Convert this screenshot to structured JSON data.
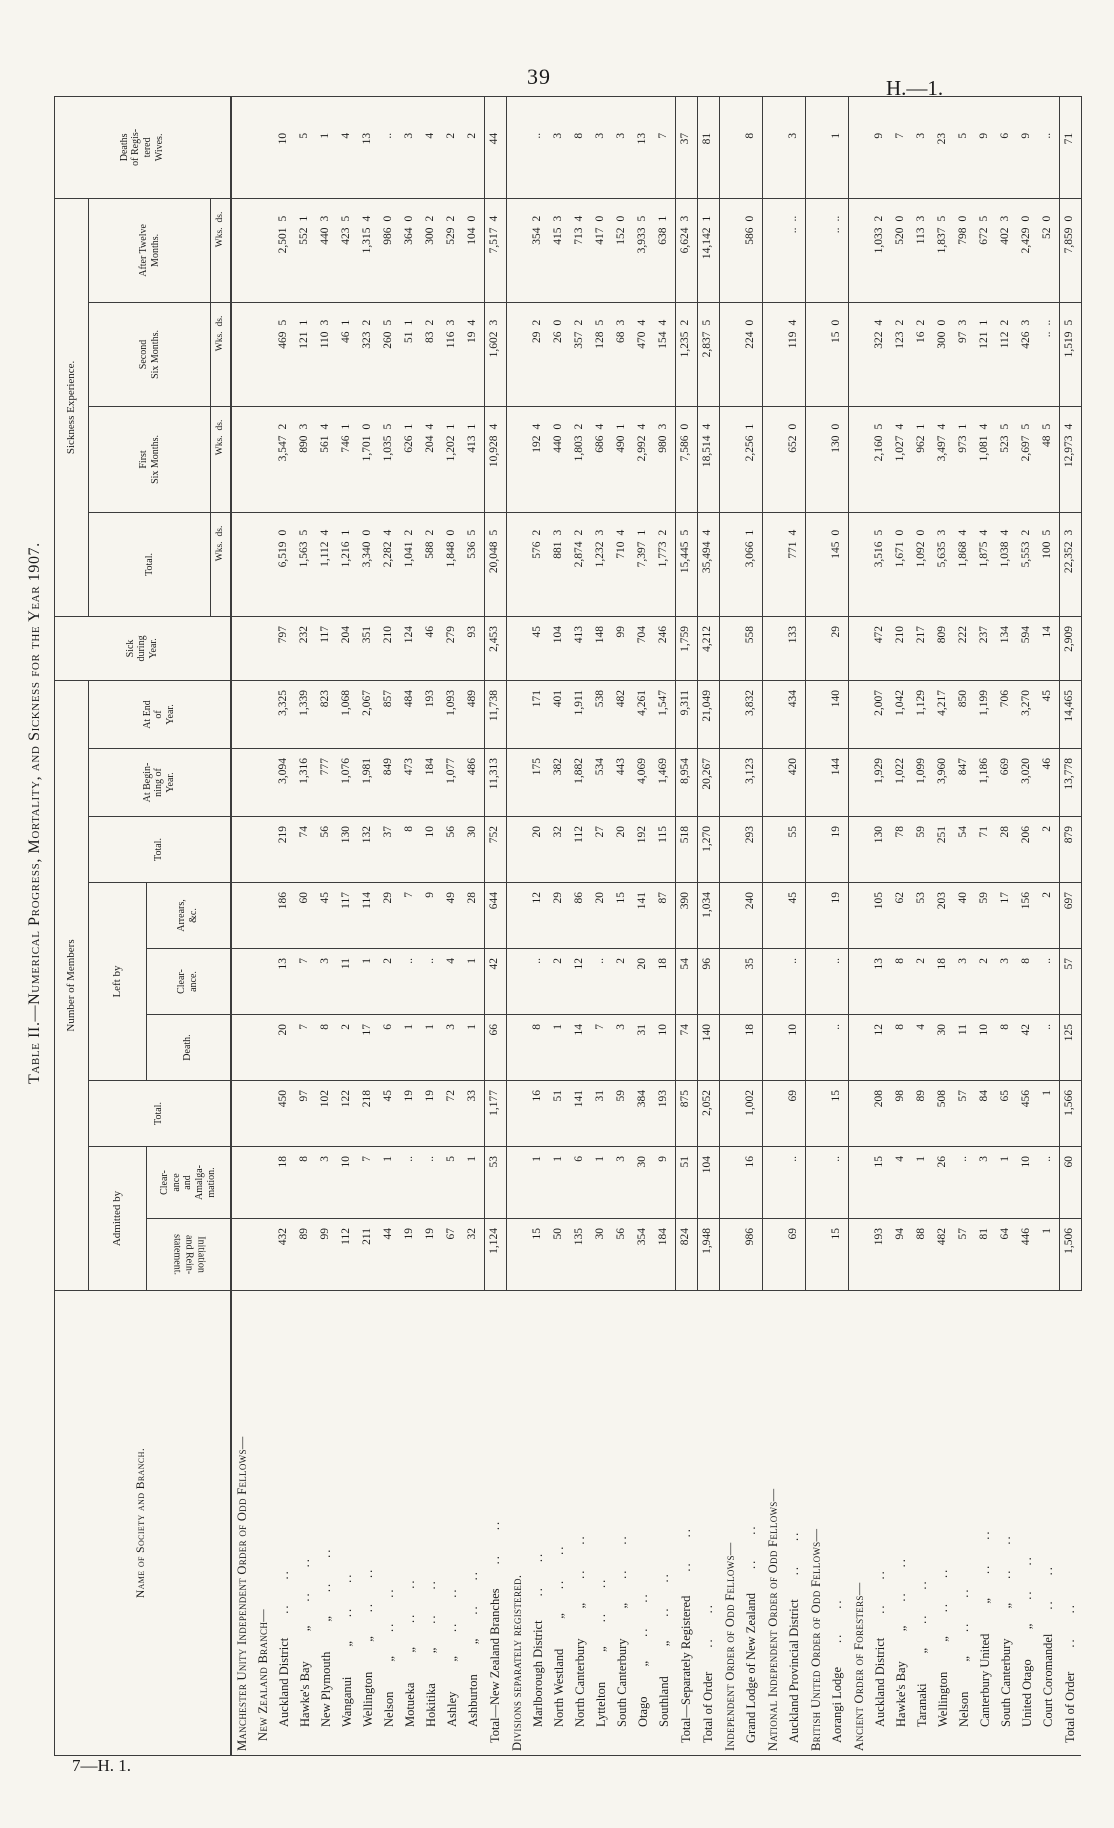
{
  "page": {
    "page_number": "39",
    "doc_ref": "H.—1.",
    "footer_ref": "7—H. 1.",
    "title": "Table II.—Numerical Progress, Mortality, and Sickness for the Year 1907."
  },
  "table": {
    "ditto_mark": "„",
    "leader_dots": "..",
    "header": {
      "name_col": "Name of Society and Branch.",
      "number_of_members": "Number of Members",
      "admitted_by": "Admitted by",
      "initiation": "Initiation\nand Rein-\nstatement.",
      "clearance_amalgamation": "Clear-\nance\nand\nAmalga-\nmation.",
      "total_admitted": "Total.",
      "left_by": "Left by",
      "death": "Death.",
      "clearance": "Clear-\nance.",
      "arrears": "Arrears,\n&c.",
      "total_left": "Total.",
      "at_beginning": "At Begin-\nning of\nYear.",
      "at_end": "At End\nof\nYear.",
      "sick_during_year": "Sick\nduring\nYear.",
      "sickness_experience": "Sickness Experience.",
      "total_sick": "Total.",
      "first_six": "First\nSix Months.",
      "second_six": "Second\nSix Months.",
      "after_twelve": "After Twelve\nMonths.",
      "deaths_wives": "Deaths\nof Regis-\ntered\nWives.",
      "wks": "Wks.",
      "ds": "ds."
    },
    "rows": [
      {
        "type": "heading",
        "level": 1,
        "text": "Manchester Unity Independent Order of Odd Fellows—"
      },
      {
        "type": "heading",
        "level": 2,
        "text": "New Zealand Branch—"
      },
      {
        "type": "data",
        "name": "Auckland District",
        "indent": 2,
        "v": [
          "432",
          "18",
          "450",
          "20",
          "13",
          "186",
          "219",
          "3,094",
          "3,325",
          "797",
          "6,519",
          "0",
          "3,547",
          "2",
          "469",
          "5",
          "2,501",
          "5",
          "10"
        ]
      },
      {
        "type": "data",
        "name": "Hawke's Bay",
        "ditto": true,
        "indent": 2,
        "v": [
          "89",
          "8",
          "97",
          "7",
          "7",
          "60",
          "74",
          "1,316",
          "1,339",
          "232",
          "1,563",
          "5",
          "890",
          "3",
          "121",
          "1",
          "552",
          "1",
          "5"
        ]
      },
      {
        "type": "data",
        "name": "New Plymouth",
        "ditto": true,
        "indent": 2,
        "v": [
          "99",
          "3",
          "102",
          "8",
          "3",
          "45",
          "56",
          "777",
          "823",
          "117",
          "1,112",
          "4",
          "561",
          "4",
          "110",
          "3",
          "440",
          "3",
          "1"
        ]
      },
      {
        "type": "data",
        "name": "Wanganui",
        "ditto": true,
        "indent": 2,
        "v": [
          "112",
          "10",
          "122",
          "2",
          "11",
          "117",
          "130",
          "1,076",
          "1,068",
          "204",
          "1,216",
          "1",
          "746",
          "1",
          "46",
          "1",
          "423",
          "5",
          "4"
        ]
      },
      {
        "type": "data",
        "name": "Wellington",
        "ditto": true,
        "indent": 2,
        "v": [
          "211",
          "7",
          "218",
          "17",
          "1",
          "114",
          "132",
          "1,981",
          "2,067",
          "351",
          "3,340",
          "0",
          "1,701",
          "0",
          "323",
          "2",
          "1,315",
          "4",
          "13"
        ]
      },
      {
        "type": "data",
        "name": "Nelson",
        "ditto": true,
        "indent": 2,
        "v": [
          "44",
          "1",
          "45",
          "6",
          "2",
          "29",
          "37",
          "849",
          "857",
          "210",
          "2,282",
          "4",
          "1,035",
          "5",
          "260",
          "5",
          "986",
          "0",
          ".."
        ]
      },
      {
        "type": "data",
        "name": "Motueka",
        "ditto": true,
        "indent": 2,
        "v": [
          "19",
          "..",
          "19",
          "1",
          "..",
          "7",
          "8",
          "473",
          "484",
          "124",
          "1,041",
          "2",
          "626",
          "1",
          "51",
          "1",
          "364",
          "0",
          "3"
        ]
      },
      {
        "type": "data",
        "name": "Hokitika",
        "ditto": true,
        "indent": 2,
        "v": [
          "19",
          "..",
          "19",
          "1",
          "..",
          "9",
          "10",
          "184",
          "193",
          "46",
          "588",
          "2",
          "204",
          "4",
          "83",
          "2",
          "300",
          "2",
          "4"
        ]
      },
      {
        "type": "data",
        "name": "Ashley",
        "ditto": true,
        "indent": 2,
        "v": [
          "67",
          "5",
          "72",
          "3",
          "4",
          "49",
          "56",
          "1,077",
          "1,093",
          "279",
          "1,848",
          "0",
          "1,202",
          "1",
          "116",
          "3",
          "529",
          "2",
          "2"
        ]
      },
      {
        "type": "data",
        "name": "Ashburton",
        "ditto": true,
        "indent": 2,
        "v": [
          "32",
          "1",
          "33",
          "1",
          "1",
          "28",
          "30",
          "486",
          "489",
          "93",
          "536",
          "5",
          "413",
          "1",
          "19",
          "4",
          "104",
          "0",
          "2"
        ]
      },
      {
        "type": "total",
        "name": "Total—New Zealand Branches",
        "indent": 1,
        "end": true,
        "v": [
          "1,124",
          "53",
          "1,177",
          "66",
          "42",
          "644",
          "752",
          "11,313",
          "11,738",
          "2,453",
          "20,048",
          "5",
          "10,928",
          "4",
          "1,602",
          "3",
          "7,517",
          "4",
          "44"
        ]
      },
      {
        "type": "heading",
        "level": 1,
        "text": "Divisions separately registered."
      },
      {
        "type": "data",
        "name": "Marlborough District",
        "indent": 2,
        "v": [
          "15",
          "1",
          "16",
          "8",
          "..",
          "12",
          "20",
          "175",
          "171",
          "45",
          "576",
          "2",
          "192",
          "4",
          "29",
          "2",
          "354",
          "2",
          ".."
        ]
      },
      {
        "type": "data",
        "name": "North Westland",
        "ditto": true,
        "indent": 2,
        "v": [
          "50",
          "1",
          "51",
          "1",
          "2",
          "29",
          "32",
          "382",
          "401",
          "104",
          "881",
          "3",
          "440",
          "0",
          "26",
          "0",
          "415",
          "3",
          "3"
        ]
      },
      {
        "type": "data",
        "name": "North Canterbury",
        "ditto": true,
        "indent": 2,
        "v": [
          "135",
          "6",
          "141",
          "14",
          "12",
          "86",
          "112",
          "1,882",
          "1,911",
          "413",
          "2,874",
          "2",
          "1,803",
          "2",
          "357",
          "2",
          "713",
          "4",
          "8"
        ]
      },
      {
        "type": "data",
        "name": "Lyttelton",
        "ditto": true,
        "indent": 2,
        "v": [
          "30",
          "1",
          "31",
          "7",
          "..",
          "20",
          "27",
          "534",
          "538",
          "148",
          "1,232",
          "3",
          "686",
          "4",
          "128",
          "5",
          "417",
          "0",
          "3"
        ]
      },
      {
        "type": "data",
        "name": "South Canterbury",
        "ditto": true,
        "indent": 2,
        "v": [
          "56",
          "3",
          "59",
          "3",
          "2",
          "15",
          "20",
          "443",
          "482",
          "99",
          "710",
          "4",
          "490",
          "1",
          "68",
          "3",
          "152",
          "0",
          "3"
        ]
      },
      {
        "type": "data",
        "name": "Otago",
        "ditto": true,
        "indent": 2,
        "v": [
          "354",
          "30",
          "384",
          "31",
          "20",
          "141",
          "192",
          "4,069",
          "4,261",
          "704",
          "7,397",
          "1",
          "2,992",
          "4",
          "470",
          "4",
          "3,933",
          "5",
          "13"
        ]
      },
      {
        "type": "data",
        "name": "Southland",
        "ditto": true,
        "indent": 2,
        "v": [
          "184",
          "9",
          "193",
          "10",
          "18",
          "87",
          "115",
          "1,469",
          "1,547",
          "246",
          "1,773",
          "2",
          "980",
          "3",
          "154",
          "4",
          "638",
          "1",
          "7"
        ]
      },
      {
        "type": "total",
        "name": "Total—Separately Registered",
        "indent": 1,
        "v": [
          "824",
          "51",
          "875",
          "74",
          "54",
          "390",
          "518",
          "8,954",
          "9,311",
          "1,759",
          "15,445",
          "5",
          "7,586",
          "0",
          "1,235",
          "2",
          "6,624",
          "3",
          "37"
        ]
      },
      {
        "type": "total",
        "name": "Total of Order",
        "indent": 1,
        "end": true,
        "v": [
          "1,948",
          "104",
          "2,052",
          "140",
          "96",
          "1,034",
          "1,270",
          "20,267",
          "21,049",
          "4,212",
          "35,494",
          "4",
          "18,514",
          "4",
          "2,837",
          "5",
          "14,142",
          "1",
          "81"
        ]
      },
      {
        "type": "heading",
        "level": 1,
        "text": "Independent Order of Odd Fellows—"
      },
      {
        "type": "data",
        "name": "Grand Lodge of New Zealand",
        "indent": 1,
        "end": true,
        "v": [
          "986",
          "16",
          "1,002",
          "18",
          "35",
          "240",
          "293",
          "3,123",
          "3,832",
          "558",
          "3,066",
          "1",
          "2,256",
          "1",
          "224",
          "0",
          "586",
          "0",
          "8"
        ]
      },
      {
        "type": "heading",
        "level": 1,
        "text": "National Independent Order of Odd Fellows—"
      },
      {
        "type": "data",
        "name": "Auckland Provincial District",
        "indent": 1,
        "end": true,
        "v": [
          "69",
          "..",
          "69",
          "10",
          "..",
          "45",
          "55",
          "420",
          "434",
          "133",
          "771",
          "4",
          "652",
          "0",
          "119",
          "4",
          "..",
          "..",
          "3"
        ]
      },
      {
        "type": "heading",
        "level": 1,
        "text": "British United Order of Odd Fellows—"
      },
      {
        "type": "data",
        "name": "Aorangi Lodge",
        "indent": 1,
        "end": true,
        "v": [
          "15",
          "..",
          "15",
          "..",
          "..",
          "19",
          "19",
          "144",
          "140",
          "29",
          "145",
          "0",
          "130",
          "0",
          "15",
          "0",
          "..",
          "..",
          "1"
        ]
      },
      {
        "type": "heading",
        "level": 1,
        "text": "Ancient Order of Foresters—"
      },
      {
        "type": "data",
        "name": "Auckland District",
        "indent": 2,
        "v": [
          "193",
          "15",
          "208",
          "12",
          "13",
          "105",
          "130",
          "1,929",
          "2,007",
          "472",
          "3,516",
          "5",
          "2,160",
          "5",
          "322",
          "4",
          "1,033",
          "2",
          "9"
        ]
      },
      {
        "type": "data",
        "name": "Hawke's Bay",
        "ditto": true,
        "indent": 2,
        "v": [
          "94",
          "4",
          "98",
          "8",
          "8",
          "62",
          "78",
          "1,022",
          "1,042",
          "210",
          "1,671",
          "0",
          "1,027",
          "4",
          "123",
          "2",
          "520",
          "0",
          "7"
        ]
      },
      {
        "type": "data",
        "name": "Taranaki",
        "ditto": true,
        "indent": 2,
        "v": [
          "88",
          "1",
          "89",
          "4",
          "2",
          "53",
          "59",
          "1,099",
          "1,129",
          "217",
          "1,092",
          "0",
          "962",
          "1",
          "16",
          "2",
          "113",
          "3",
          "3"
        ]
      },
      {
        "type": "data",
        "name": "Wellington",
        "ditto": true,
        "indent": 2,
        "v": [
          "482",
          "26",
          "508",
          "30",
          "18",
          "203",
          "251",
          "3,960",
          "4,217",
          "809",
          "5,635",
          "3",
          "3,497",
          "4",
          "300",
          "0",
          "1,837",
          "5",
          "23"
        ]
      },
      {
        "type": "data",
        "name": "Nelson",
        "ditto": true,
        "indent": 2,
        "v": [
          "57",
          "..",
          "57",
          "11",
          "3",
          "40",
          "54",
          "847",
          "850",
          "222",
          "1,868",
          "4",
          "973",
          "1",
          "97",
          "3",
          "798",
          "0",
          "5"
        ]
      },
      {
        "type": "data",
        "name": "Canterbury United",
        "ditto": true,
        "indent": 2,
        "v": [
          "81",
          "3",
          "84",
          "10",
          "2",
          "59",
          "71",
          "1,186",
          "1,199",
          "237",
          "1,875",
          "4",
          "1,081",
          "4",
          "121",
          "1",
          "672",
          "5",
          "9"
        ]
      },
      {
        "type": "data",
        "name": "South Canterbury",
        "ditto": true,
        "indent": 2,
        "v": [
          "64",
          "1",
          "65",
          "8",
          "3",
          "17",
          "28",
          "669",
          "706",
          "134",
          "1,038",
          "4",
          "523",
          "5",
          "112",
          "2",
          "402",
          "3",
          "6"
        ]
      },
      {
        "type": "data",
        "name": "United Otago",
        "ditto": true,
        "indent": 2,
        "v": [
          "446",
          "10",
          "456",
          "42",
          "8",
          "156",
          "206",
          "3,020",
          "3,270",
          "594",
          "5,553",
          "2",
          "2,697",
          "5",
          "426",
          "3",
          "2,429",
          "0",
          "9"
        ]
      },
      {
        "type": "data",
        "name": "Court Coromandel",
        "indent": 2,
        "v": [
          "1",
          "..",
          "1",
          "..",
          "..",
          "2",
          "2",
          "46",
          "45",
          "14",
          "100",
          "5",
          "48",
          "5",
          "..",
          "..",
          "52",
          "0",
          ".."
        ]
      },
      {
        "type": "total",
        "name": "Total of Order",
        "indent": 1,
        "end": true,
        "v": [
          "1,506",
          "60",
          "1,566",
          "125",
          "57",
          "697",
          "879",
          "13,778",
          "14,465",
          "2,909",
          "22,352",
          "3",
          "12,973",
          "4",
          "1,519",
          "5",
          "7,859",
          "0",
          "71"
        ]
      }
    ]
  }
}
